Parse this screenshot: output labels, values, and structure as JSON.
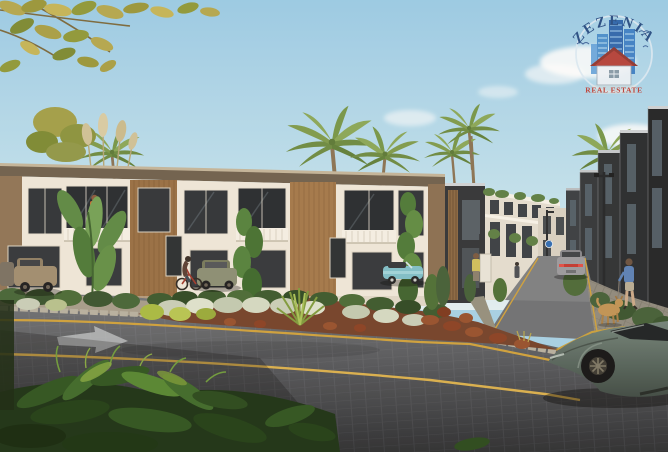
{
  "watermark": {
    "brand": "ZEZENIA",
    "tagline": "REAL ESTATE",
    "brand_color": "#27497e",
    "tagline_color": "#c23a2e"
  },
  "scene": {
    "description": "Architectural render of a residential compound: two-storey white and wood-panelled townhouses around a landscaped corner garden, cobblestone streets with yellow lane lines, parked and moving cars, pedestrians and a man walking a dog, palm trees and a blue sky",
    "sky_color": "#a6d2e8",
    "road_color": "#4a4e53",
    "lane_marking_color": "#c9a23f",
    "objects": [
      "overhanging-branch",
      "palm-trees",
      "pampas-grass",
      "townhouse-row-left",
      "dark-accent-block",
      "back-white-buildings",
      "dark-townhouse-row-right",
      "street-lamp",
      "blue-round-sign",
      "corner-garden-bed",
      "yucca-plant",
      "cobblestone-road",
      "receding-street",
      "road-arrow-marking",
      "yellow-lane-lines",
      "parked-beige-car",
      "parked-olive-car",
      "teal-convertible-car",
      "silver-car-driving",
      "sports-car-foreground",
      "balcony-person",
      "cyclist",
      "pedestrian-yellow-top",
      "tiny-pedestrian",
      "man-walking-dog",
      "dog",
      "foreground-ferns"
    ]
  }
}
